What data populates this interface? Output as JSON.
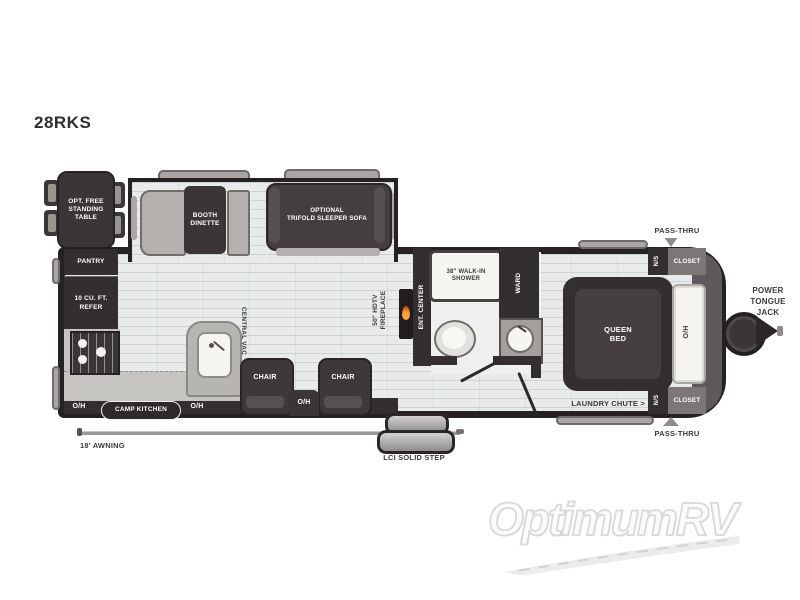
{
  "title": "28RKS",
  "watermark": "OptimumRV",
  "colors": {
    "wall_outline": "#262223",
    "dark_furniture": "#3a3537",
    "gray_furniture": "#b3b0ae",
    "floor": "#e9ebeb",
    "flame_accent": "#e0711f"
  },
  "exterior": {
    "pass_thru_top": "PASS-THRU",
    "pass_thru_bottom": "PASS-THRU",
    "power_tongue_jack": "POWER\nTONGUE\nJACK",
    "awning": "18' AWNING",
    "step": "LCI SOLID STEP"
  },
  "option_table": "OPT. FREE\nSTANDING\nTABLE",
  "slideout": {
    "dinette": "BOOTH\nDINETTE",
    "sofa": "OPTIONAL\nTRIFOLD SLEEPER SOFA"
  },
  "kitchen": {
    "pantry": "PANTRY",
    "refer": "10 CU. FT.\nREFER",
    "camp_kitchen": "CAMP KITCHEN",
    "oh_left": "O/H",
    "oh_mid": "O/H"
  },
  "living": {
    "central_vac": "CENTRAL VAC",
    "chair_left": "CHAIR",
    "chair_right": "CHAIR",
    "oh_console": "O/H",
    "fireplace": "50\" HDTV\nFIREPLACE",
    "ent_center": "ENT. CENTER"
  },
  "bath": {
    "shower": "38\" WALK-IN\nSHOWER",
    "ward": "WARD"
  },
  "bedroom": {
    "bed": "QUEEN\nBED",
    "oh": "O/H",
    "ns_top": "N/S",
    "ns_bottom": "N/S",
    "closet_top": "CLOSET",
    "closet_bottom": "CLOSET",
    "laundry": "LAUNDRY CHUTE >"
  }
}
